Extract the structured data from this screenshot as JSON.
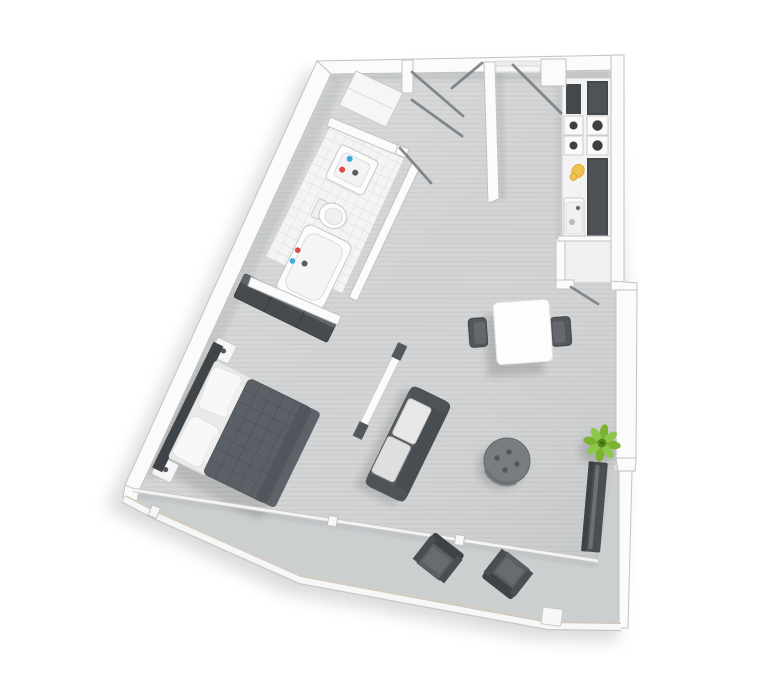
{
  "scene": {
    "title": "Studio apartment floor plan (3D top view)",
    "view": "top-down render, no text labels",
    "background": "#ffffff"
  },
  "colors": {
    "floor": "#d2d4d5",
    "floor_stripe": "#c3c5c6",
    "balcony_floor": "#cccfd0",
    "closet_floor": "#f0f0f0",
    "wall_fill": "#fbfbfb",
    "wall_stroke": "#c2c2c2",
    "tile_floor": "#f4f4f4",
    "tile_line": "#dcdcdc",
    "dark_furniture": "#464b4f",
    "appliance_dark": "#43484c",
    "duvet": "#5a6066",
    "duvet_grid": "#4c5258",
    "sofa": "#585d61",
    "sofa_back": "#484d51",
    "cushion_light": "#e8e8e8",
    "ottoman": "#797d80",
    "ottoman_dot": "#53575a",
    "chair_dark": "#53575b",
    "balcony_chair": "#5b5f62",
    "balcony_chair_back": "#3f4347",
    "plant_green": "#79b32f",
    "plant_green_light": "#8ec84a",
    "plant_core": "#55881e",
    "tap_blue": "#3fa9e0",
    "tap_red": "#e04848",
    "kitchen_item_yellow": "#edc14e",
    "door_swing": "#75797c",
    "railing_trim": "#d8cbbb",
    "fixture_white": "#fcfcfc",
    "fixture_stroke": "#c6c6c6",
    "shadow": "#84888c"
  },
  "rooms": [
    {
      "name": "entry-hall",
      "features": [
        "entry-door-recess",
        "double-closet-door-swings",
        "corner-closet"
      ]
    },
    {
      "name": "bathroom",
      "features": [
        "washbasin-with-hot-cold-taps",
        "toilet",
        "bathtub-with-taps",
        "tiled-floor",
        "door-swing"
      ]
    },
    {
      "name": "kitchen",
      "features": [
        "four-burner-stove",
        "kitchen-sink",
        "dark-counter-blocks",
        "yellow-utensil"
      ]
    },
    {
      "name": "storage-closet",
      "features": [
        "door-swing"
      ]
    },
    {
      "name": "living-dining",
      "features": [
        "square-dining-table",
        "two-dining-chairs",
        "two-seat-sofa",
        "round-ottoman",
        "tv-room-divider",
        "potted-plant",
        "radiator-shelf"
      ]
    },
    {
      "name": "sleeping-area",
      "features": [
        "double-bed-quilted-duvet",
        "pillows",
        "two-nightstands",
        "headboard",
        "dark-sideboard"
      ]
    },
    {
      "name": "balcony",
      "features": [
        "two-lounge-chairs-facing-each-other",
        "glass-wall",
        "perimeter-railing"
      ]
    }
  ],
  "furniture_counts": {
    "beds": 1,
    "sofas": 1,
    "dining_chairs": 2,
    "balcony_chairs": 2,
    "tables": 2,
    "plants": 1
  }
}
